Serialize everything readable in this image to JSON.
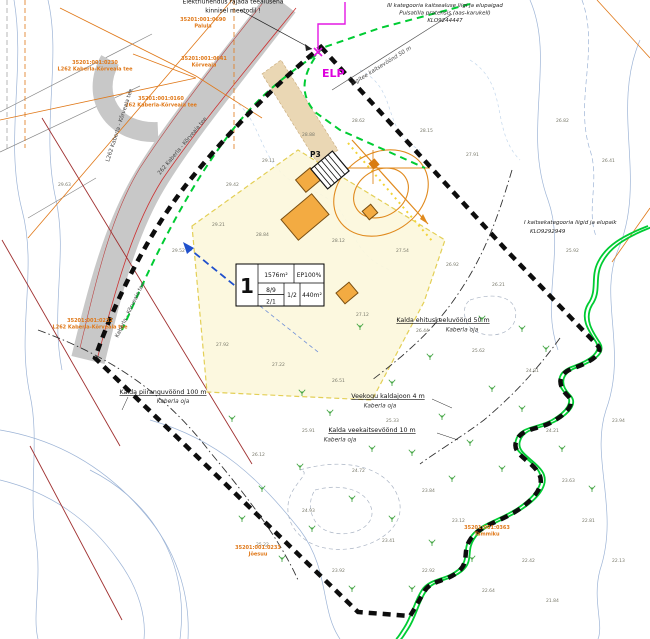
{
  "map_title": "Detailplaneeringu põhijoonis",
  "notes": {
    "construction": {
      "line1": "Elektriühendus rajada teealusena",
      "line2": "kinnisel meetodil !"
    },
    "species": {
      "line1": "III kategooria kaitsealuse liigi ja elupaigad",
      "line2": "Pulsatilla pratensis (aas-karukell)",
      "line3": "KLO9244447"
    },
    "habitat": {
      "line1": "I kaitsekategooria liigid ja elupaik",
      "line2": "KLO9292949"
    },
    "road_zone": "riigitee kaitsevöönd 50 m"
  },
  "markers": {
    "elp": "ELP",
    "parking": "P3"
  },
  "zones": [
    {
      "title": "Kalda piiranguvöönd 100 m",
      "sub": "Kaberla oja"
    },
    {
      "title": "Veekogu kaldajoon 4 m",
      "sub": "Kaberla oja"
    },
    {
      "title": "Kalda veekaitsevöönd 10 m",
      "sub": "Kaberla oja"
    },
    {
      "title": "Kalda ehituskeeluvöönd 50 m",
      "sub": "Kaberla oja"
    }
  ],
  "plot_table": {
    "pos": "1",
    "area": "1576m²",
    "ep": "EP100%",
    "r2a": "8/9",
    "r2b": "2/1",
    "r2c": "1/2",
    "r2d": "440m²"
  },
  "road_names": [
    {
      "text": "L262 Kaberla - Kõrveaia tee"
    },
    {
      "text": "Kaberla - Kõrveaia tee"
    },
    {
      "text": "262 Kaberla - Kõrveaia tee"
    }
  ],
  "cadastral_labels": [
    {
      "x": 203,
      "y": 21,
      "code": "35201:001:0690",
      "name": "Palula"
    },
    {
      "x": 204,
      "y": 60,
      "code": "35201:001:0641",
      "name": "Kõrveaia"
    },
    {
      "x": 95,
      "y": 64,
      "code": "35201:001:0230",
      "name": "L262 Kaberla-Kõrveaia tee"
    },
    {
      "x": 161,
      "y": 100,
      "code": "35201:001:0160",
      "name": "262 Kaberla-Kõrveaia tee"
    },
    {
      "x": 90,
      "y": 322,
      "code": "35201:001:0232",
      "name": "L262 Kaberla-Kõrveaia tee"
    },
    {
      "x": 487,
      "y": 529,
      "code": "35201:001:0363",
      "name": "Tammiku"
    },
    {
      "x": 258,
      "y": 549,
      "code": "35201:001:0233",
      "name": "Jõesuu"
    }
  ],
  "elevations": [
    {
      "x": 352,
      "y": 122,
      "v": "28.62"
    },
    {
      "x": 420,
      "y": 132,
      "v": "28.15"
    },
    {
      "x": 466,
      "y": 156,
      "v": "27.91"
    },
    {
      "x": 302,
      "y": 136,
      "v": "28.88"
    },
    {
      "x": 262,
      "y": 162,
      "v": "29.11"
    },
    {
      "x": 226,
      "y": 186,
      "v": "29.42"
    },
    {
      "x": 212,
      "y": 226,
      "v": "29.21"
    },
    {
      "x": 256,
      "y": 236,
      "v": "28.84"
    },
    {
      "x": 332,
      "y": 242,
      "v": "28.12"
    },
    {
      "x": 396,
      "y": 252,
      "v": "27.54"
    },
    {
      "x": 446,
      "y": 266,
      "v": "26.92"
    },
    {
      "x": 492,
      "y": 286,
      "v": "26.21"
    },
    {
      "x": 242,
      "y": 292,
      "v": "28.41"
    },
    {
      "x": 296,
      "y": 306,
      "v": "27.83"
    },
    {
      "x": 356,
      "y": 316,
      "v": "27.12"
    },
    {
      "x": 416,
      "y": 332,
      "v": "26.44"
    },
    {
      "x": 472,
      "y": 352,
      "v": "25.62"
    },
    {
      "x": 526,
      "y": 372,
      "v": "24.81"
    },
    {
      "x": 216,
      "y": 346,
      "v": "27.92"
    },
    {
      "x": 272,
      "y": 366,
      "v": "27.22"
    },
    {
      "x": 332,
      "y": 382,
      "v": "26.51"
    },
    {
      "x": 386,
      "y": 422,
      "v": "25.33"
    },
    {
      "x": 302,
      "y": 432,
      "v": "25.91"
    },
    {
      "x": 252,
      "y": 456,
      "v": "26.12"
    },
    {
      "x": 352,
      "y": 472,
      "v": "24.72"
    },
    {
      "x": 422,
      "y": 492,
      "v": "23.84"
    },
    {
      "x": 302,
      "y": 512,
      "v": "24.93"
    },
    {
      "x": 382,
      "y": 542,
      "v": "23.41"
    },
    {
      "x": 452,
      "y": 522,
      "v": "23.12"
    },
    {
      "x": 256,
      "y": 546,
      "v": "25.22"
    },
    {
      "x": 332,
      "y": 572,
      "v": "23.92"
    },
    {
      "x": 546,
      "y": 432,
      "v": "24.21"
    },
    {
      "x": 562,
      "y": 482,
      "v": "23.63"
    },
    {
      "x": 612,
      "y": 422,
      "v": "23.94"
    },
    {
      "x": 582,
      "y": 522,
      "v": "22.81"
    },
    {
      "x": 522,
      "y": 562,
      "v": "22.42"
    },
    {
      "x": 612,
      "y": 562,
      "v": "22.13"
    },
    {
      "x": 482,
      "y": 592,
      "v": "22.64"
    },
    {
      "x": 546,
      "y": 602,
      "v": "21.84"
    },
    {
      "x": 422,
      "y": 572,
      "v": "22.92"
    },
    {
      "x": 556,
      "y": 122,
      "v": "26.82"
    },
    {
      "x": 602,
      "y": 162,
      "v": "26.41"
    },
    {
      "x": 566,
      "y": 252,
      "v": "25.92"
    },
    {
      "x": 58,
      "y": 186,
      "v": "29.63"
    },
    {
      "x": 172,
      "y": 252,
      "v": "29.52"
    }
  ],
  "vegetation_points": [
    {
      "x": 360,
      "y": 330
    },
    {
      "x": 430,
      "y": 360
    },
    {
      "x": 392,
      "y": 386
    },
    {
      "x": 330,
      "y": 416
    },
    {
      "x": 442,
      "y": 420
    },
    {
      "x": 492,
      "y": 392
    },
    {
      "x": 522,
      "y": 412
    },
    {
      "x": 470,
      "y": 446
    },
    {
      "x": 372,
      "y": 452
    },
    {
      "x": 300,
      "y": 470
    },
    {
      "x": 262,
      "y": 492
    },
    {
      "x": 412,
      "y": 456
    },
    {
      "x": 352,
      "y": 502
    },
    {
      "x": 452,
      "y": 482
    },
    {
      "x": 502,
      "y": 472
    },
    {
      "x": 312,
      "y": 532
    },
    {
      "x": 392,
      "y": 522
    },
    {
      "x": 432,
      "y": 546
    },
    {
      "x": 472,
      "y": 562
    },
    {
      "x": 282,
      "y": 562
    },
    {
      "x": 352,
      "y": 592
    },
    {
      "x": 412,
      "y": 592
    },
    {
      "x": 522,
      "y": 332
    },
    {
      "x": 546,
      "y": 352
    },
    {
      "x": 482,
      "y": 322
    },
    {
      "x": 562,
      "y": 452
    },
    {
      "x": 592,
      "y": 492
    },
    {
      "x": 302,
      "y": 396
    },
    {
      "x": 232,
      "y": 422
    },
    {
      "x": 242,
      "y": 522
    }
  ],
  "colors": {
    "boundary": "#0d0d0d",
    "stream_green": "#00cc33",
    "cadastral_orange": "#e07818",
    "building_fill": "#f3ab42",
    "plot_fill": "#fcf7dc",
    "road_gray": "#c8c8c8",
    "power_magenta": "#dd00dd",
    "contour_blue": "#9db4d6",
    "red_line": "#a03030"
  }
}
